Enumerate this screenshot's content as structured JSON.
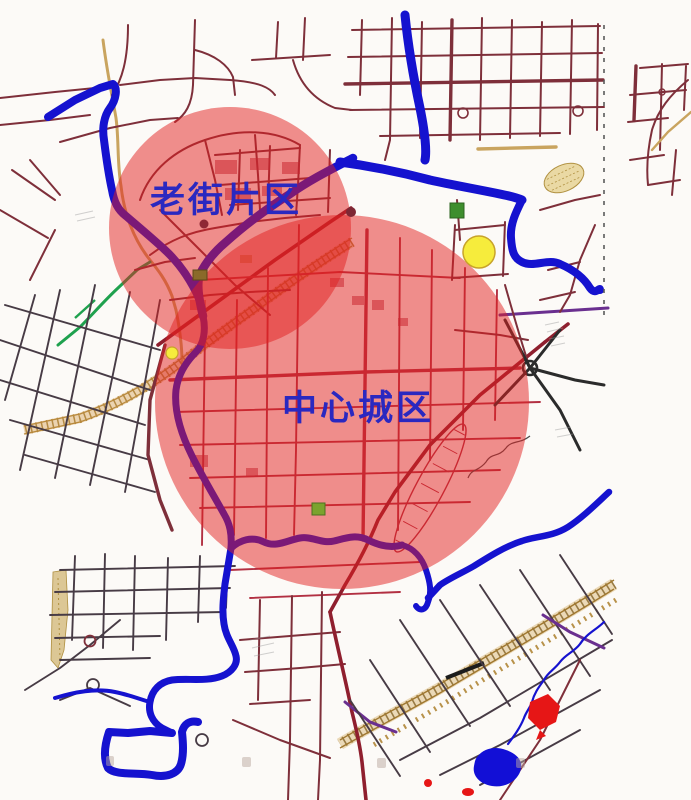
{
  "map": {
    "kind": "urban-planning-map",
    "labels": {
      "old_town": "老街片区",
      "central": "中心城区"
    },
    "regions": [
      {
        "id": "old-town",
        "label": "老街片区",
        "cx": 230,
        "cy": 228,
        "r": 121
      },
      {
        "id": "central",
        "label": "中心城区",
        "cx": 342,
        "cy": 402,
        "r": 187
      }
    ]
  },
  "colors": {
    "bg": "#fcfaf7",
    "river": "#1512cf",
    "lake": "#120fd6",
    "road-maroon": "#7e2f3a",
    "road-dark": "#473b45",
    "road-crimson": "#b23042",
    "road-artery": "#8f1f2e",
    "road-purple": "#6a2f8f",
    "highlight": "#e12020",
    "label-blue": "#2a28c0",
    "landmark-yellow": "#f6ec3c",
    "landmark-yellow-edge": "#c8a32a",
    "railway-tan": "#c9a45f",
    "railway-tie": "#7a5c22",
    "corridor-orange": "#a87828",
    "green-road": "#1fa14e",
    "green-block": "#3e8e2e",
    "olive-block": "#7ba32e",
    "brown-block": "#8a6a2a",
    "red-zone": "#e61616",
    "boundary-dash": "#5a5a5a",
    "hatch-sand": "#dcc795"
  }
}
